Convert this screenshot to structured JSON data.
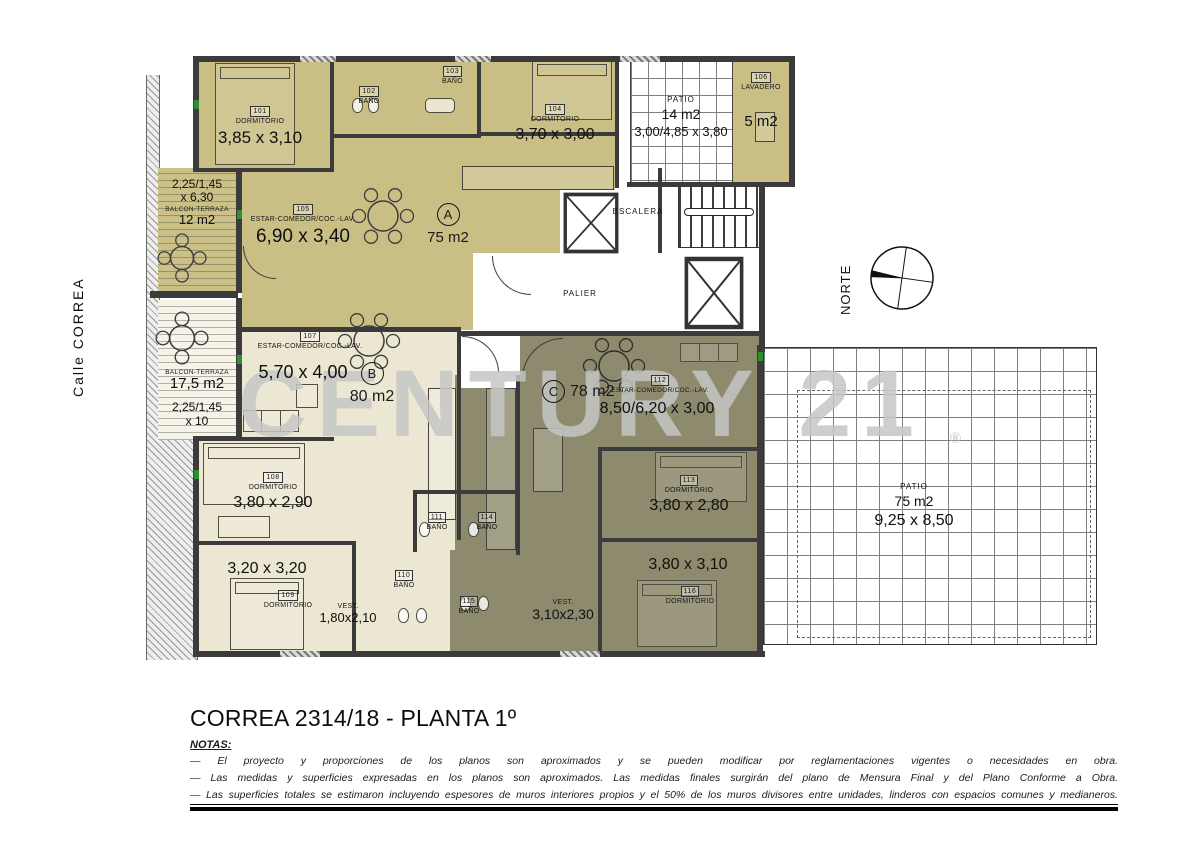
{
  "sheet": {
    "title": "CORREA 2314/18 - PLANTA 1º",
    "notas_label": "NOTAS:",
    "notes": [
      "—  El proyecto y proporciones de los planos son aproximados y se pueden modificar por reglamentaciones vigentes o necesidades en obra.",
      "—  Las medidas y superficies expresadas en los planos son aproximados. Las medidas finales surgirán del plano de Mensura Final y del Plano Conforme a Obra.",
      "—  Las superficies totales se estimaron incluyendo espesores de muros interiores propios y el 50% de los muros divisores entre unidades, linderos con espacios comunes y medianeros."
    ],
    "street": "Calle CORREA",
    "north": "NORTE",
    "watermark": "CENTURY 21",
    "registered": "®"
  },
  "colors": {
    "unit_a_fill": "#c9bf85",
    "unit_b_fill": "#ece7d2",
    "unit_c_fill": "#8e8a6d",
    "wall": "#3b3b3b",
    "watermark_gray": "#c5c5c5",
    "window_green": "#2f8f2f"
  },
  "common": {
    "escalera": "ESCALERA",
    "palier": "PALIER",
    "patio_top": {
      "label": "PATIO",
      "area": "14 m2",
      "dims": "3,00/4,85 x 3,80"
    },
    "patio_right": {
      "label": "PATIO",
      "area": "75 m2",
      "dims": "9,25 x 8,50"
    },
    "lavadero": {
      "number": "106",
      "label": "LAVADERO",
      "area": "5 m2"
    }
  },
  "balcony_top": {
    "dims_line1": "2,25/1,45",
    "dims_line2": "x 6,30",
    "label": "BALCON-TERRAZA",
    "area": "12 m2"
  },
  "balcony_bottom": {
    "label": "BALCON-TERRAZA",
    "area": "17,5 m2",
    "dims_line1": "2,25/1,45",
    "dims_line2": "x 10"
  },
  "unit_a": {
    "letter": "A",
    "area": "75 m2",
    "dorm101": {
      "number": "101",
      "label": "DORMITORIO",
      "dims": "3,85 x 3,10"
    },
    "bano102": {
      "number": "102",
      "label": "BAÑO"
    },
    "bano103": {
      "number": "103",
      "label": "BAÑO"
    },
    "dorm104": {
      "number": "104",
      "label": "DORMITORIO",
      "dims": "3,70 x 3,00"
    },
    "estar105": {
      "number": "105",
      "label": "ESTAR-COMEDOR/COC.-LAV.",
      "dims": "6,90 x 3,40"
    }
  },
  "unit_b": {
    "letter": "B",
    "area": "80 m2",
    "estar107": {
      "number": "107",
      "label": "ESTAR-COMEDOR/COC.-LAV.",
      "dims": "5,70 x 4,00"
    },
    "dorm108": {
      "number": "108",
      "label": "DORMITORIO",
      "dims": "3,80 x 2,90"
    },
    "dorm109": {
      "number": "109",
      "label": "DORMITORIO",
      "dims": "3,20 x 3,20"
    },
    "bano110": {
      "number": "110",
      "label": "BAÑO"
    },
    "bano111": {
      "number": "111",
      "label": "BAÑO"
    },
    "vest": {
      "label": "VEST.",
      "dims": "1,80x2,10"
    }
  },
  "unit_c": {
    "letter": "C",
    "area": "78 m2",
    "estar112": {
      "number": "112",
      "label": "ESTAR-COMEDOR/COC.-LAV.",
      "dims": "8,50/6,20 x 3,00"
    },
    "dorm113": {
      "number": "113",
      "label": "DORMITORIO",
      "dims": "3,80 x 2,80"
    },
    "bano114": {
      "number": "114",
      "label": "BAÑO"
    },
    "bano115": {
      "number": "115",
      "label": "BAÑO"
    },
    "vest": {
      "label": "VEST.",
      "dims": "3,10x2,30"
    },
    "dorm116": {
      "number": "116",
      "label": "DORMITORIO",
      "dims": "3,80 x 3,10"
    }
  }
}
